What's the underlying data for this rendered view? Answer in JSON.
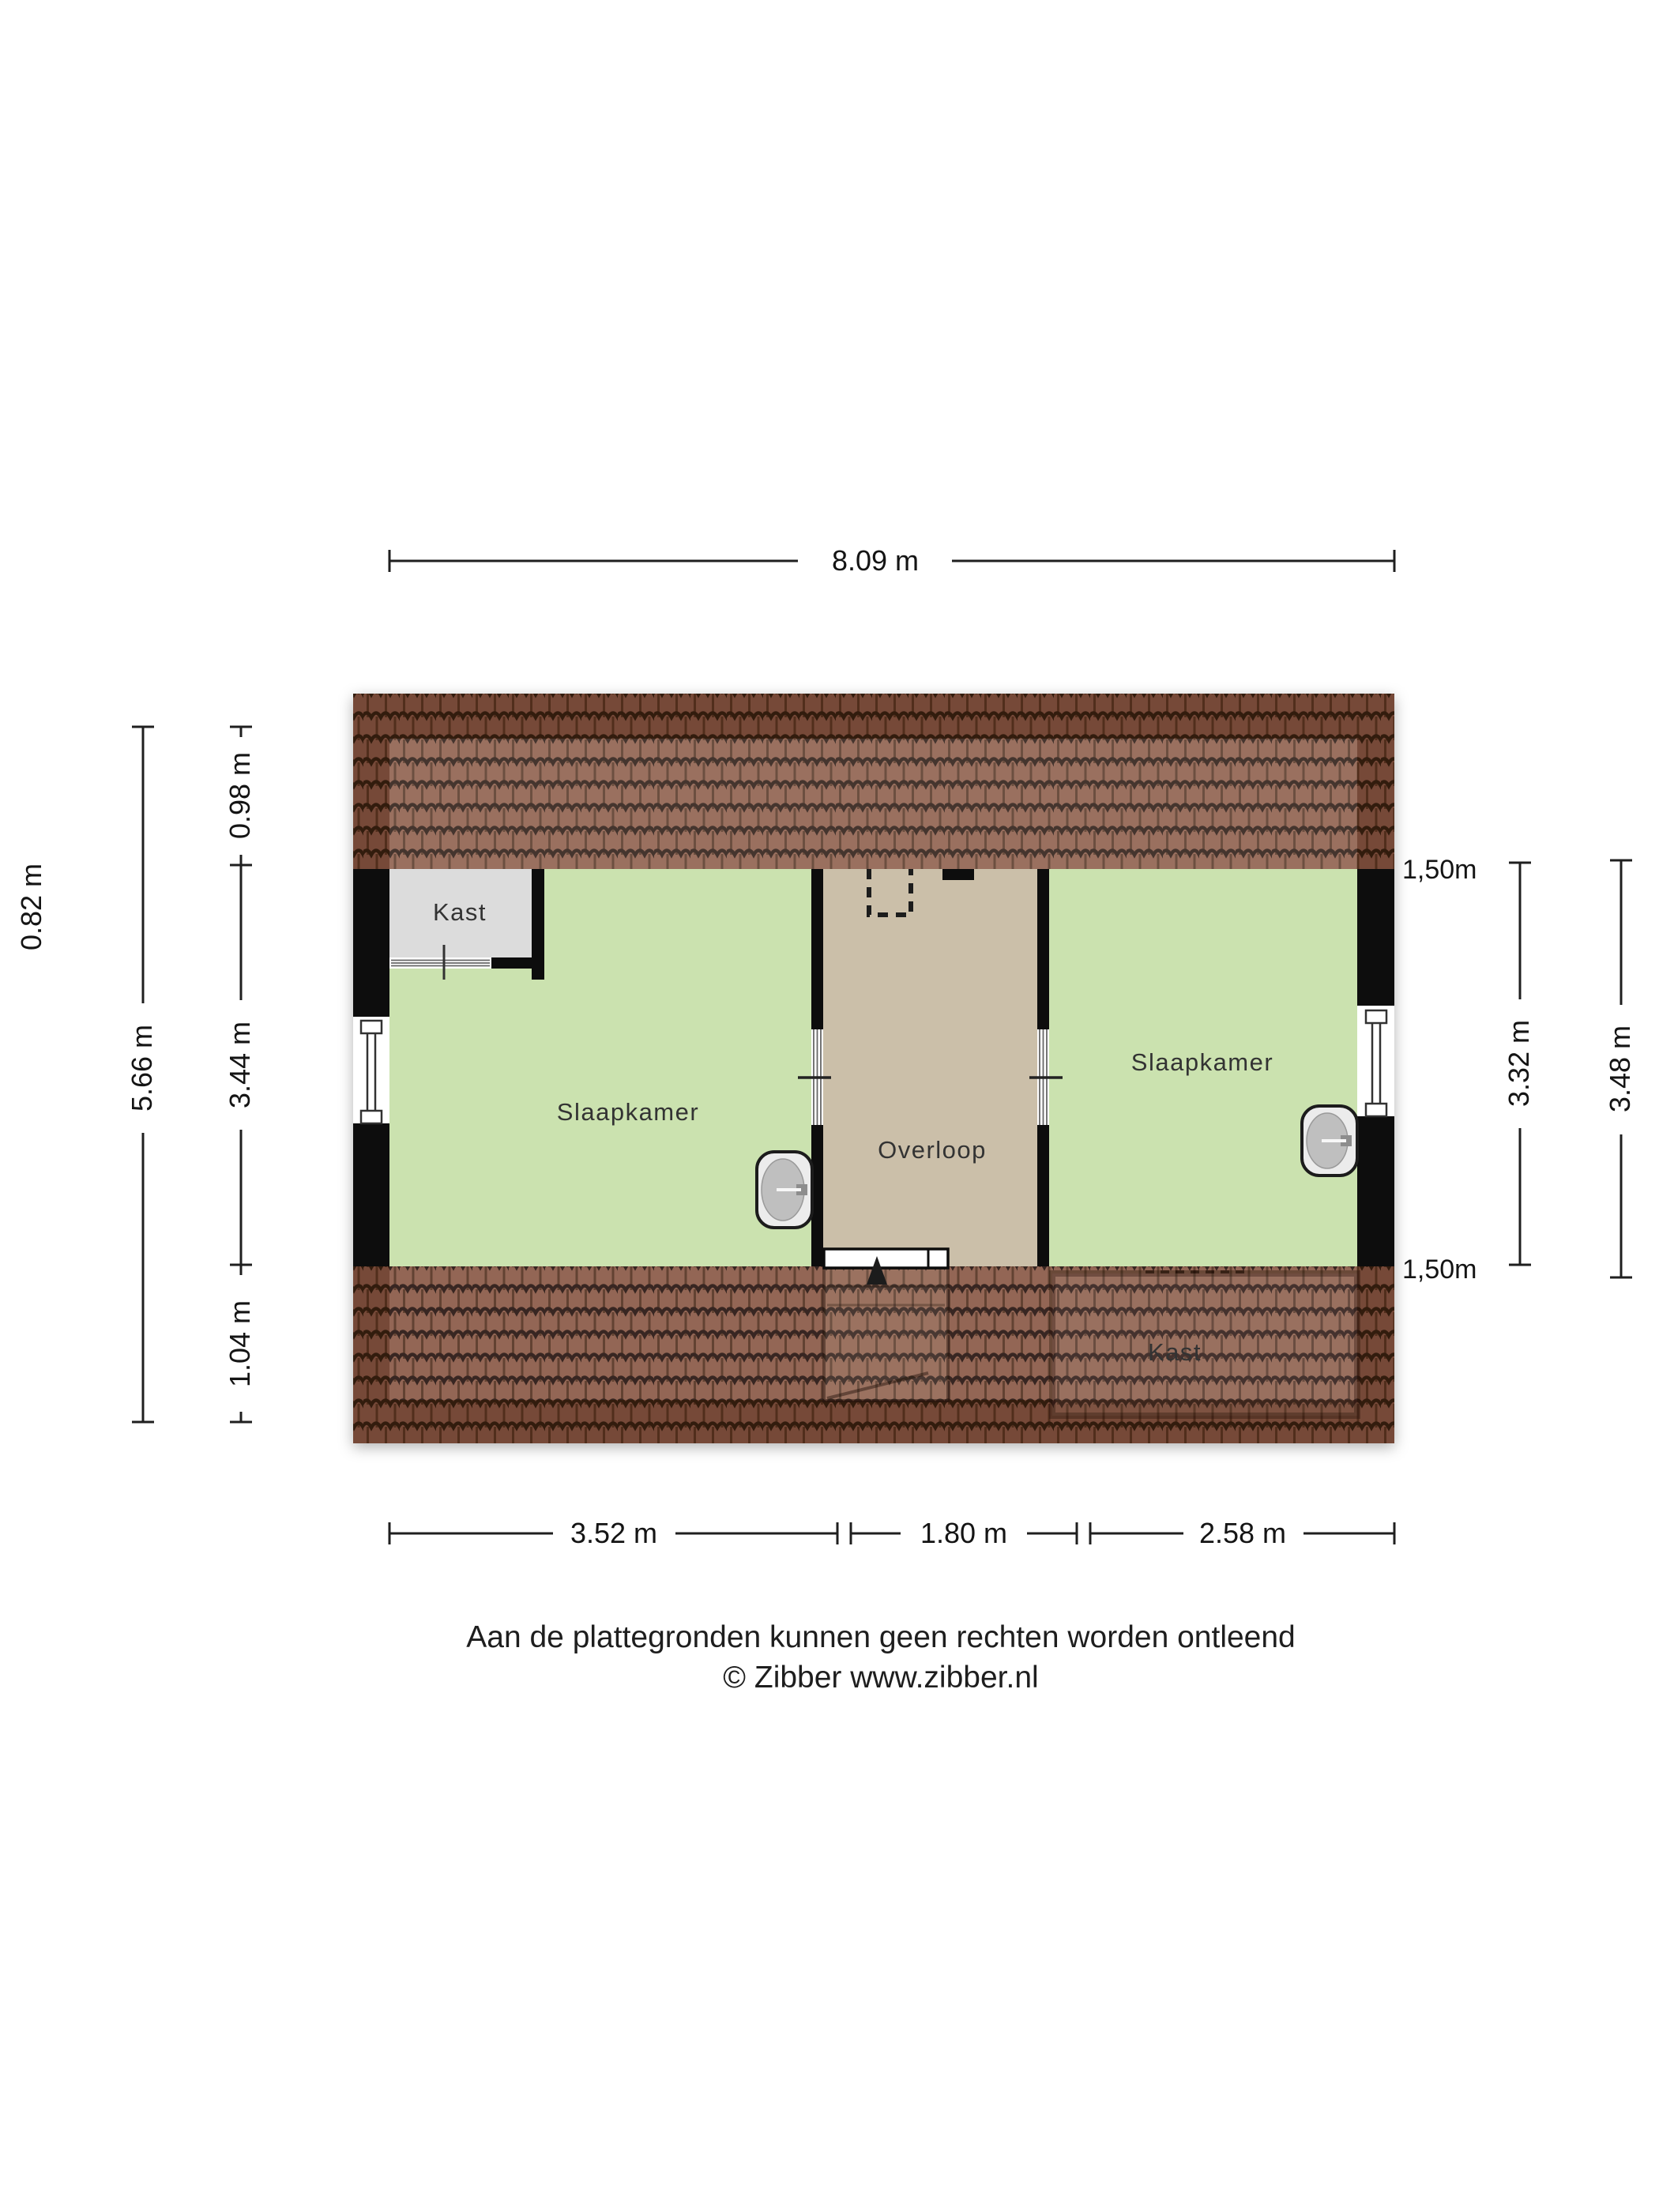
{
  "floorplan": {
    "rooms": [
      {
        "id": "closet-top-left",
        "label": "Kast"
      },
      {
        "id": "bedroom-left",
        "label": "Slaapkamer"
      },
      {
        "id": "landing",
        "label": "Overloop"
      },
      {
        "id": "bedroom-right",
        "label": "Slaapkamer"
      },
      {
        "id": "closet-under-roof",
        "label": "Kast"
      }
    ],
    "dimensions": {
      "width_total": "8.09 m",
      "left_eave": "0.82 m",
      "left_total": "5.66 m",
      "left_top": "0.98 m",
      "left_middle": "3.44 m",
      "left_bottom": "1.04 m",
      "headroom_top": "1,50m",
      "headroom_bottom": "1,50m",
      "right_inner": "3.32 m",
      "right_outer": "3.48 m",
      "bottom_left": "3.52 m",
      "bottom_middle": "1.80 m",
      "bottom_right": "2.58 m"
    },
    "colors": {
      "bedroom_green": "#cbe2af",
      "landing_tan": "#cbbfa9",
      "closet_gray": "#dcdcdc",
      "roof_tile_brown": "#8b5b47",
      "wall_black": "#0d0d0d"
    }
  },
  "footer": {
    "disclaimer": "Aan de plattegronden kunnen geen rechten worden ontleend",
    "credit": "© Zibber www.zibber.nl"
  }
}
